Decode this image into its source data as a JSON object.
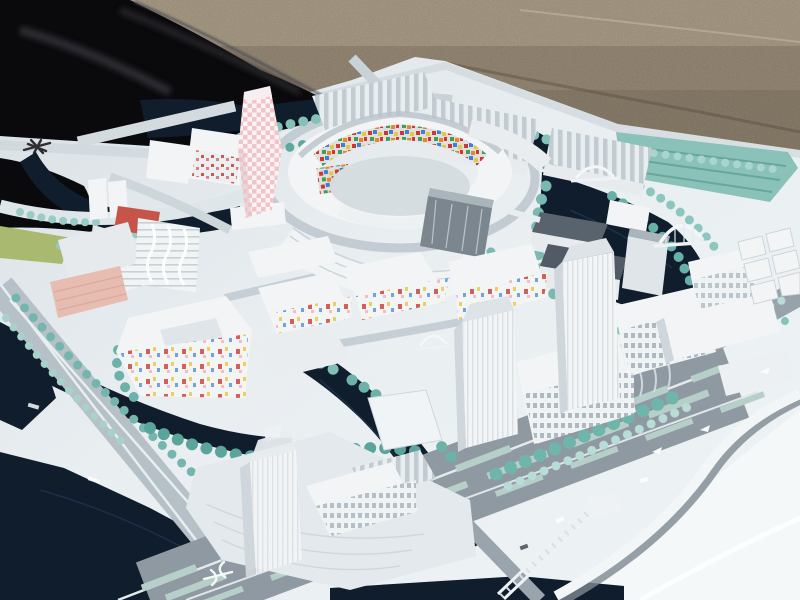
{
  "scene": {
    "description": "Photograph of a white architectural scale model of a waterfront urban district, viewed at an angle outdoors",
    "setting": "model board lying on gravel ground, partly bordered by a black tarp",
    "landmarks": {
      "central_ring": "circular courtyard building with multicolor mosaic inner facades",
      "pink_tower": "tall twisting tower with pink checkerboard skin",
      "twin_towers": "two tall white towers with gridded slab blocks",
      "south_tower": "single white tower on a tree-lined plaza island",
      "waterways": "dark navy canals looping around the districts",
      "boulevard": "wide multi-lane avenue with teal medians and a curving white flyover"
    },
    "marks": {
      "compass_mark": "small black asterisk-like registration mark on the white board",
      "transit_glyph": "white transit symbol painted on the dark roadway"
    }
  },
  "palette": {
    "gravel": "#8d7e69",
    "gravel_light": "#b3a48c",
    "gravel_dark": "#6b5e4e",
    "tarp": "#0a0a0d",
    "tarp_fold": "#2e2e35",
    "board": "#e9eef1",
    "board_bright": "#f4f8f9",
    "board_shadow": "#c9d1d7",
    "water": "#0f1d2d",
    "water_light": "#27405c",
    "road": "#b6c0c7",
    "road_dark": "#8f99a1",
    "road_light": "#dfe6e9",
    "lane_teal": "#b7cfc9",
    "tree": "#79b9b1",
    "tree_dark": "#57a198",
    "tree_mid": "#6db2a9",
    "tree_light": "#a7d2cb",
    "tree_pale": "#c9e4df",
    "platform_teal": "#8ac2ba",
    "platform_rib": "#5f9f97",
    "building": "#f2f4f5",
    "building_face": "#e7ebee",
    "building_side": "#cfd7dc",
    "roof_gray": "#aab4bb",
    "roof_dark": "#59636d",
    "glass_dark": "#7c868f",
    "mosaic_red": "#cc3832",
    "mosaic_blue": "#3a7fd9",
    "mosaic_yellow": "#e8c73c",
    "mosaic_green": "#3aa05a",
    "mosaic_orange": "#e8842c",
    "pink_tower": "#f2c3c9",
    "pink_base": "#faf4f3",
    "salmon": "#e7bdb2",
    "red_roof": "#c65448",
    "lawn": "#a9b96f",
    "mark_black": "#17171c",
    "mark_white": "#f5f8f9"
  }
}
